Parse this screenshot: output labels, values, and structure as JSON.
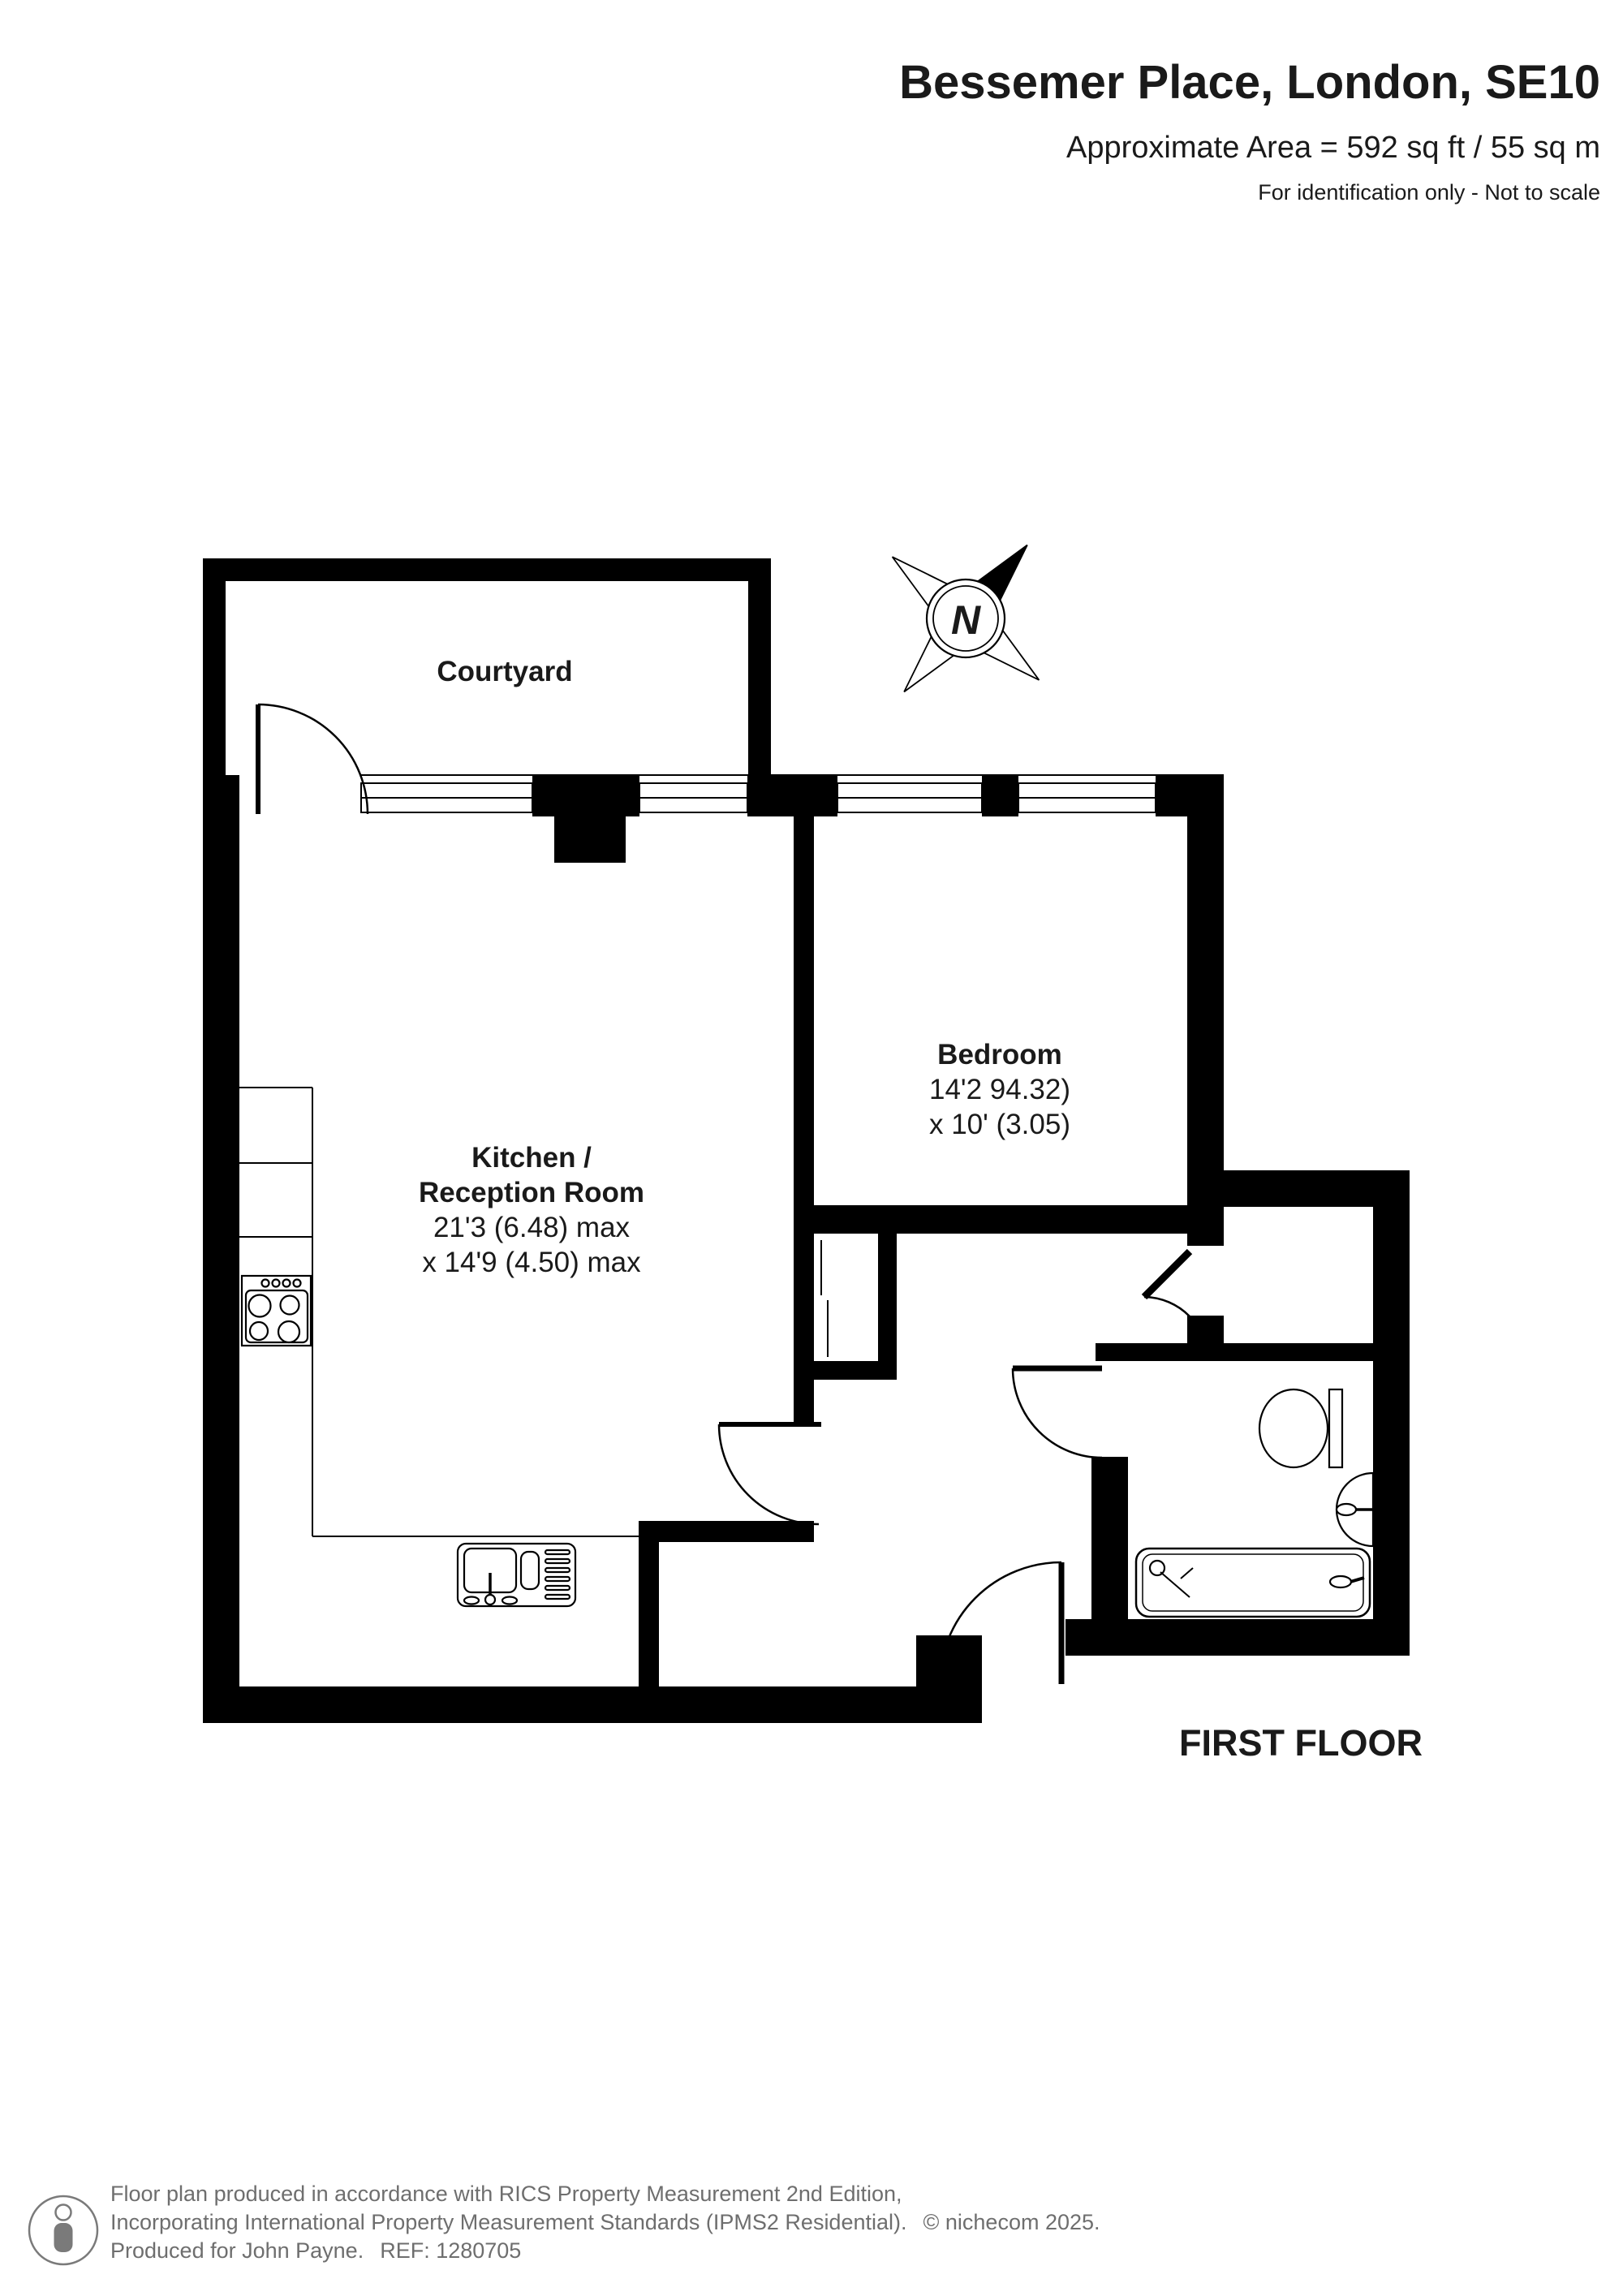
{
  "header": {
    "title": "Bessemer Place, London, SE10",
    "area": "Approximate Area = 592 sq ft / 55 sq m",
    "note": "For identification only - Not to scale"
  },
  "plan": {
    "rooms": {
      "courtyard": {
        "label": "Courtyard"
      },
      "kitchen": {
        "label_line1": "Kitchen /",
        "label_line2": "Reception Room",
        "dims_line1": "21'3 (6.48) max",
        "dims_line2": "x 14'9 (4.50) max"
      },
      "bedroom": {
        "label": "Bedroom",
        "dims_line1": "14'2 94.32)",
        "dims_line2": "x 10' (3.05)"
      }
    },
    "floor_label": "FIRST FLOOR",
    "compass": {
      "north_label": "N"
    }
  },
  "footer": {
    "line1": "Floor plan produced in accordance with RICS Property Measurement 2nd Edition,",
    "line2": "Incorporating International Property Measurement Standards (IPMS2 Residential).",
    "copyright": "© nichecom 2025.",
    "produced_for": "Produced for John Payne.",
    "ref": "REF: 1280705"
  },
  "colors": {
    "wall": "#000000",
    "background": "#ffffff",
    "footer_text": "#6e6e6e"
  }
}
